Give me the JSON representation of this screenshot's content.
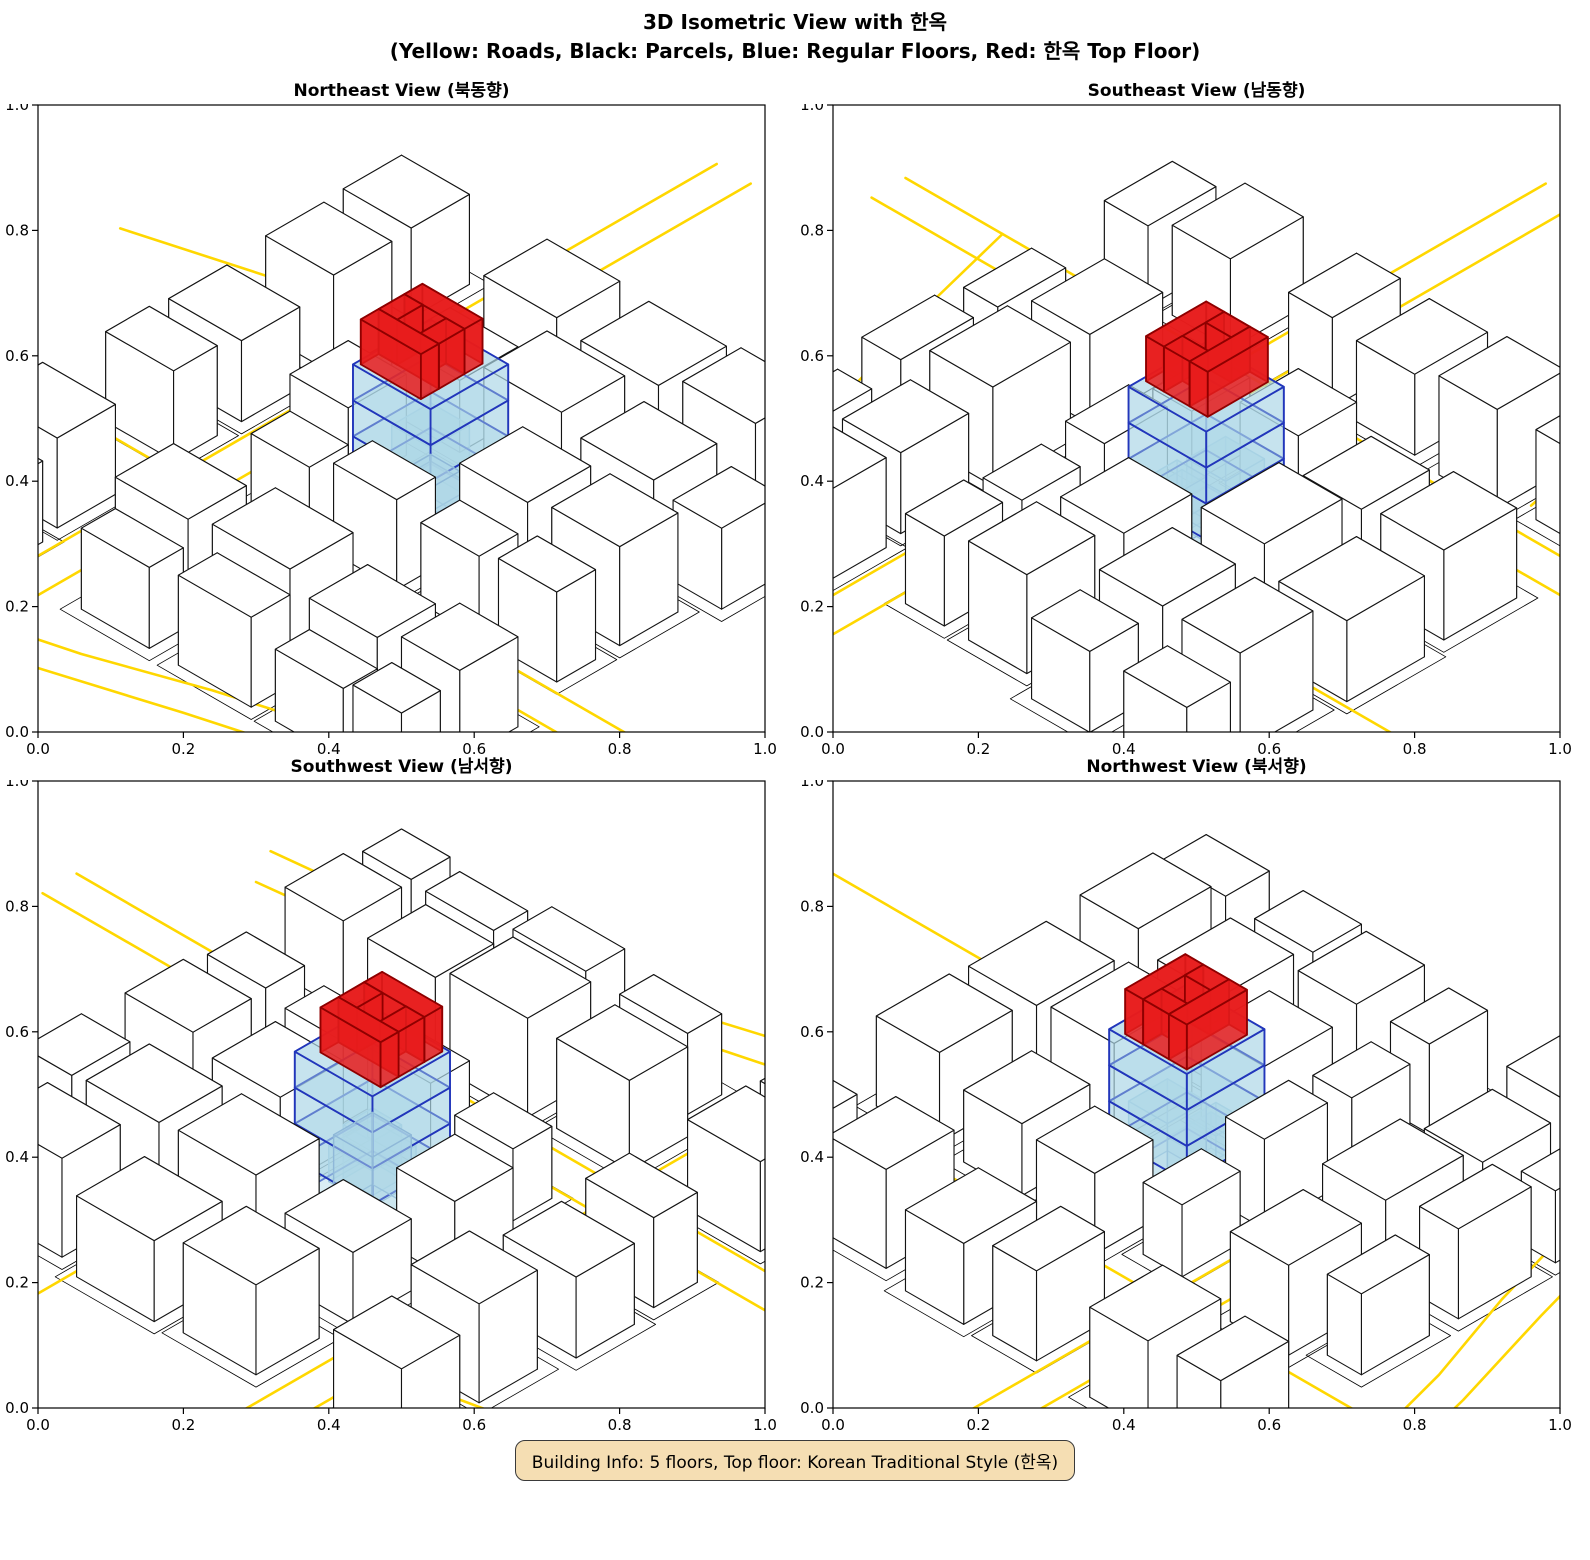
{
  "title": {
    "line1": "3D Isometric View with 한옥",
    "line2": "(Yellow: Roads, Black: Parcels, Blue: Regular Floors, Red: 한옥 Top Floor)"
  },
  "views": [
    {
      "id": "northeast",
      "title": "Northeast View (북동향)",
      "rot": 0
    },
    {
      "id": "southeast",
      "title": "Southeast View (남동향)",
      "rot": 90
    },
    {
      "id": "southwest",
      "title": "Southwest View (남서향)",
      "rot": 180
    },
    {
      "id": "northwest",
      "title": "Northwest View (북서향)",
      "rot": 270
    }
  ],
  "axes": {
    "ticks": [
      "0.0",
      "0.2",
      "0.4",
      "0.6",
      "0.8",
      "1.0"
    ],
    "range": [
      0.0,
      1.0
    ]
  },
  "footer": {
    "building_info": "Building Info: 5 floors, Top floor: Korean Traditional Style (한옥)"
  },
  "colors": {
    "road": "#FFD700",
    "parcel": "#000000",
    "context_fill": "#FFFFFF",
    "context_edge": "#141414",
    "floor_fill": "rgba(173,216,230,0.45)",
    "floor_edge": "#2236BB",
    "sub_fill": "rgba(173,216,230,0.32)",
    "sub_edge": "#8FB8D8",
    "hanok_fill": "rgba(232,28,28,0.85)",
    "hanok_edge": "#8F0000",
    "frame": "#000000",
    "infobox_bg": "#F5DEB3",
    "infobox_border": "#3a3a3a"
  },
  "chart_data": {
    "type": "3d-isometric-scene",
    "title": "3D Isometric View with 한옥",
    "legend": {
      "yellow": "Roads",
      "black": "Parcels",
      "blue": "Regular Floors",
      "red": "한옥 Top Floor"
    },
    "views": [
      "Northeast View (북동향)",
      "Southeast View (남동향)",
      "Southwest View (남서향)",
      "Northwest View (북서향)"
    ],
    "building": {
      "floors": 5,
      "regular_floors": 4,
      "top_floor_style": "Korean Traditional (한옥)",
      "top_floor_shape": "courtyard-ring"
    },
    "axis_range": [
      0.0,
      1.0
    ],
    "scene": {
      "roads": [
        [
          [
            -45,
            66
          ],
          [
            140,
            66
          ]
        ],
        [
          [
            -45,
            73
          ],
          [
            140,
            73
          ]
        ],
        [
          [
            20,
            -45
          ],
          [
            20,
            140
          ]
        ],
        [
          [
            27,
            -45
          ],
          [
            27,
            140
          ]
        ],
        [
          [
            27,
            112
          ],
          [
            42,
            108
          ],
          [
            62,
            101
          ],
          [
            86,
            94
          ],
          [
            120,
            90
          ]
        ],
        [
          [
            20,
            120
          ],
          [
            40,
            115
          ],
          [
            63,
            108
          ],
          [
            88,
            101
          ],
          [
            124,
            97
          ]
        ],
        [
          [
            -30,
            28
          ],
          [
            -5,
            21
          ],
          [
            14,
            17
          ]
        ],
        [
          [
            69,
            -45
          ],
          [
            69,
            18
          ]
        ]
      ],
      "context_buildings": [
        [
          2,
          2,
          16,
          14,
          10
        ],
        [
          4,
          20,
          18,
          32,
          11
        ],
        [
          2,
          38,
          17,
          50,
          9
        ],
        [
          3,
          55,
          17,
          64,
          10
        ],
        [
          2,
          76,
          17,
          88,
          10
        ],
        [
          4,
          92,
          18,
          101,
          9
        ],
        [
          32,
          2,
          47,
          15,
          10
        ],
        [
          52,
          1,
          68,
          15,
          9
        ],
        [
          73,
          3,
          88,
          15,
          11
        ],
        [
          91,
          2,
          100,
          15,
          9
        ],
        [
          31,
          21,
          45,
          33,
          8
        ],
        [
          50,
          20,
          66,
          33,
          11
        ],
        [
          71,
          21,
          86,
          34,
          10
        ],
        [
          90,
          22,
          100,
          34,
          9
        ],
        [
          28,
          39,
          40,
          51,
          9
        ],
        [
          63,
          38,
          77,
          51,
          10
        ],
        [
          82,
          39,
          96,
          51,
          11
        ],
        [
          33,
          56,
          45,
          64,
          8
        ],
        [
          50,
          56,
          63,
          64,
          10
        ],
        [
          68,
          56,
          80,
          64,
          9
        ],
        [
          84,
          56,
          96,
          64,
          10
        ],
        [
          30,
          77,
          45,
          89,
          10
        ],
        [
          50,
          76,
          66,
          89,
          11
        ],
        [
          70,
          77,
          84,
          89,
          9
        ],
        [
          88,
          76,
          100,
          88,
          10
        ],
        [
          34,
          93,
          48,
          100,
          9
        ],
        [
          54,
          92,
          69,
          100,
          10
        ],
        [
          74,
          93,
          88,
          100,
          8
        ],
        [
          90,
          92,
          100,
          100,
          9
        ]
      ],
      "central_building": {
        "rect": [
          44,
          38,
          60,
          54
        ],
        "regular_floors": 4,
        "floor_height": 4,
        "sub_volumes": [
          [
            46,
            40,
            54,
            48,
            0,
            8
          ],
          [
            50,
            44,
            59,
            53,
            0,
            4
          ],
          [
            52,
            46,
            58,
            52,
            0,
            6
          ]
        ],
        "hanok": {
          "z0": 16,
          "z1": 21,
          "strips": [
            [
              44.8,
              40.5,
              57.2,
              44.2
            ],
            [
              44.8,
              49.5,
              57.2,
              53.2
            ],
            [
              44.8,
              44.2,
              48.6,
              49.5
            ],
            [
              53.4,
              44.2,
              57.2,
              49.5
            ]
          ]
        }
      },
      "parcel_margin": 2.2
    }
  }
}
